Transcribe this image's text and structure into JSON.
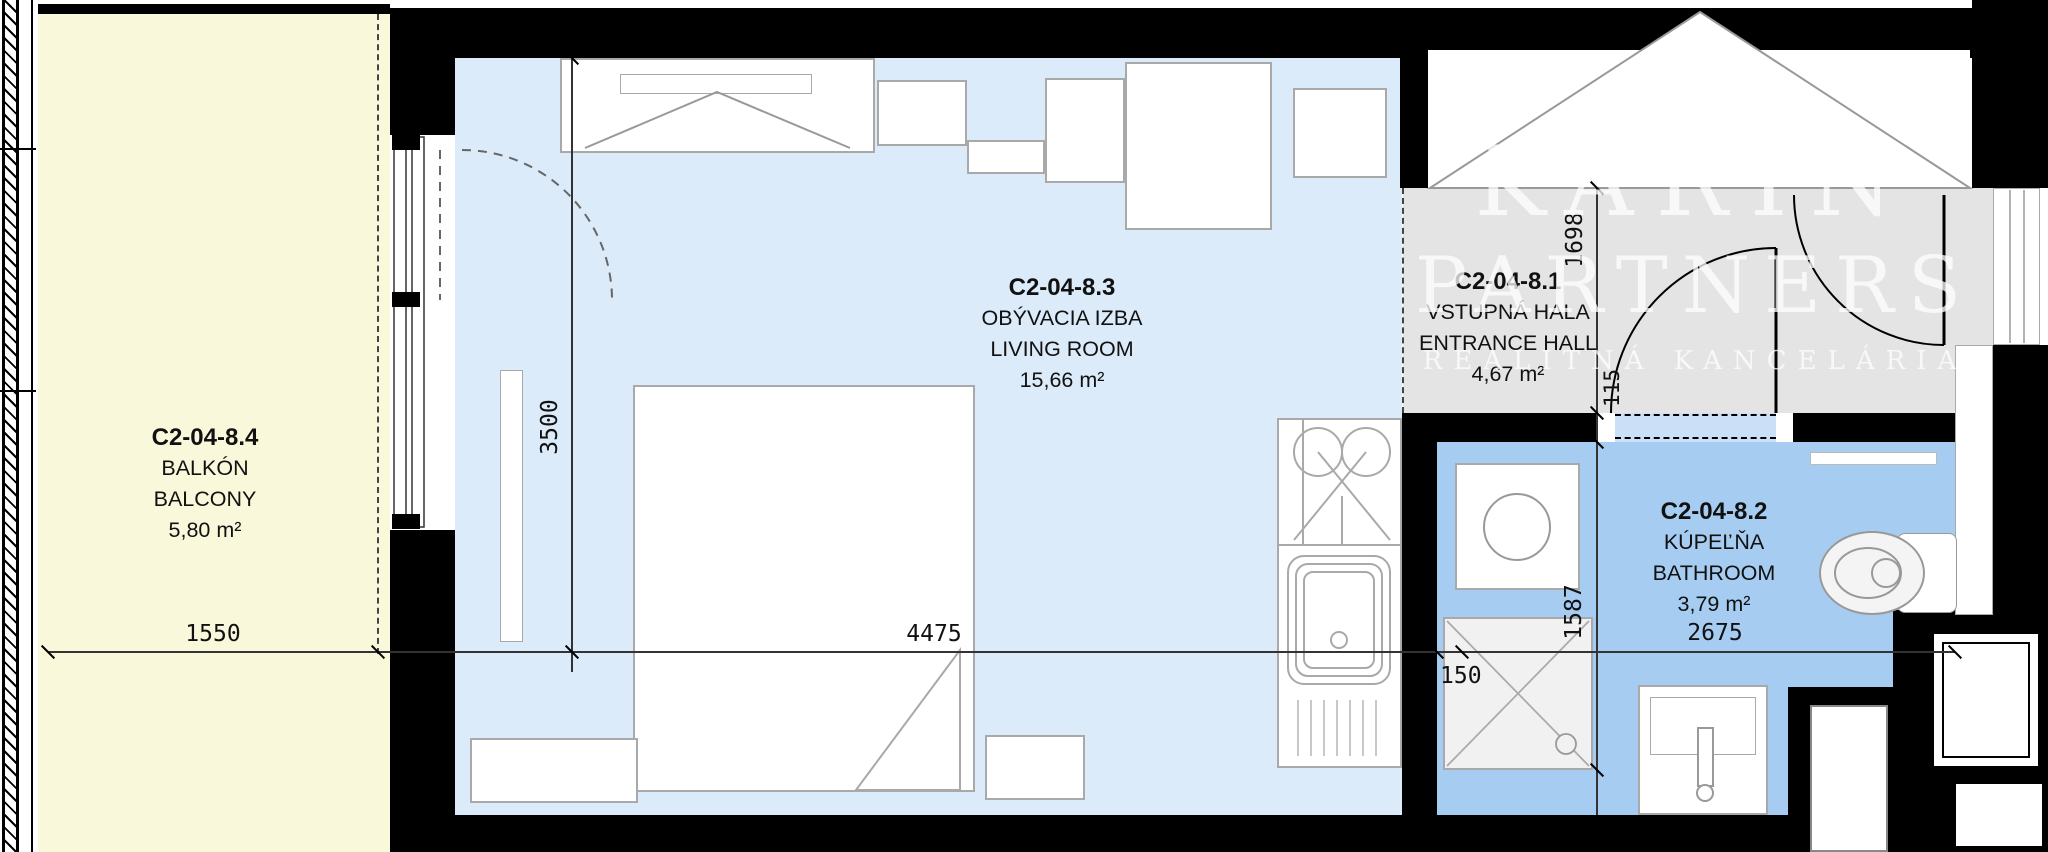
{
  "title": "Apartment floor plan C2-04-8",
  "rooms": [
    {
      "code": "C2-04-8.4",
      "name_local": "BALKÓN",
      "name_en": "BALCONY",
      "area": "5,80 m²"
    },
    {
      "code": "C2-04-8.3",
      "name_local": "OBÝVACIA IZBA",
      "name_en": "LIVING ROOM",
      "area": "15,66 m²"
    },
    {
      "code": "C2-04-8.1",
      "name_local": "VSTUPNÁ HALA",
      "name_en": "ENTRANCE HALL",
      "area": "4,67 m²"
    },
    {
      "code": "C2-04-8.2",
      "name_local": "KÚPEĽŇA",
      "name_en": "BATHROOM",
      "area": "3,79 m²"
    }
  ],
  "dimensions": {
    "balcony_width": "1550",
    "living_room_width": "4475",
    "living_room_depth": "3500",
    "entrance_hall_depth": "1698",
    "bathroom_wall": "115",
    "bathroom_depth": "1587",
    "bathroom_niche": "150",
    "bathroom_width": "2675"
  },
  "watermark": {
    "line1": "KARIN",
    "line2": "PARTNERS",
    "line3": "REALITNÁ KANCELÁRIA"
  },
  "colors": {
    "balcony": "#FAF8DB",
    "living_room": "#DCEBF9",
    "entrance_hall": "#E4E4E4",
    "bathroom": "#A6CDF1",
    "bathroom_door": "#CBE0F6",
    "wall": "#000000"
  }
}
